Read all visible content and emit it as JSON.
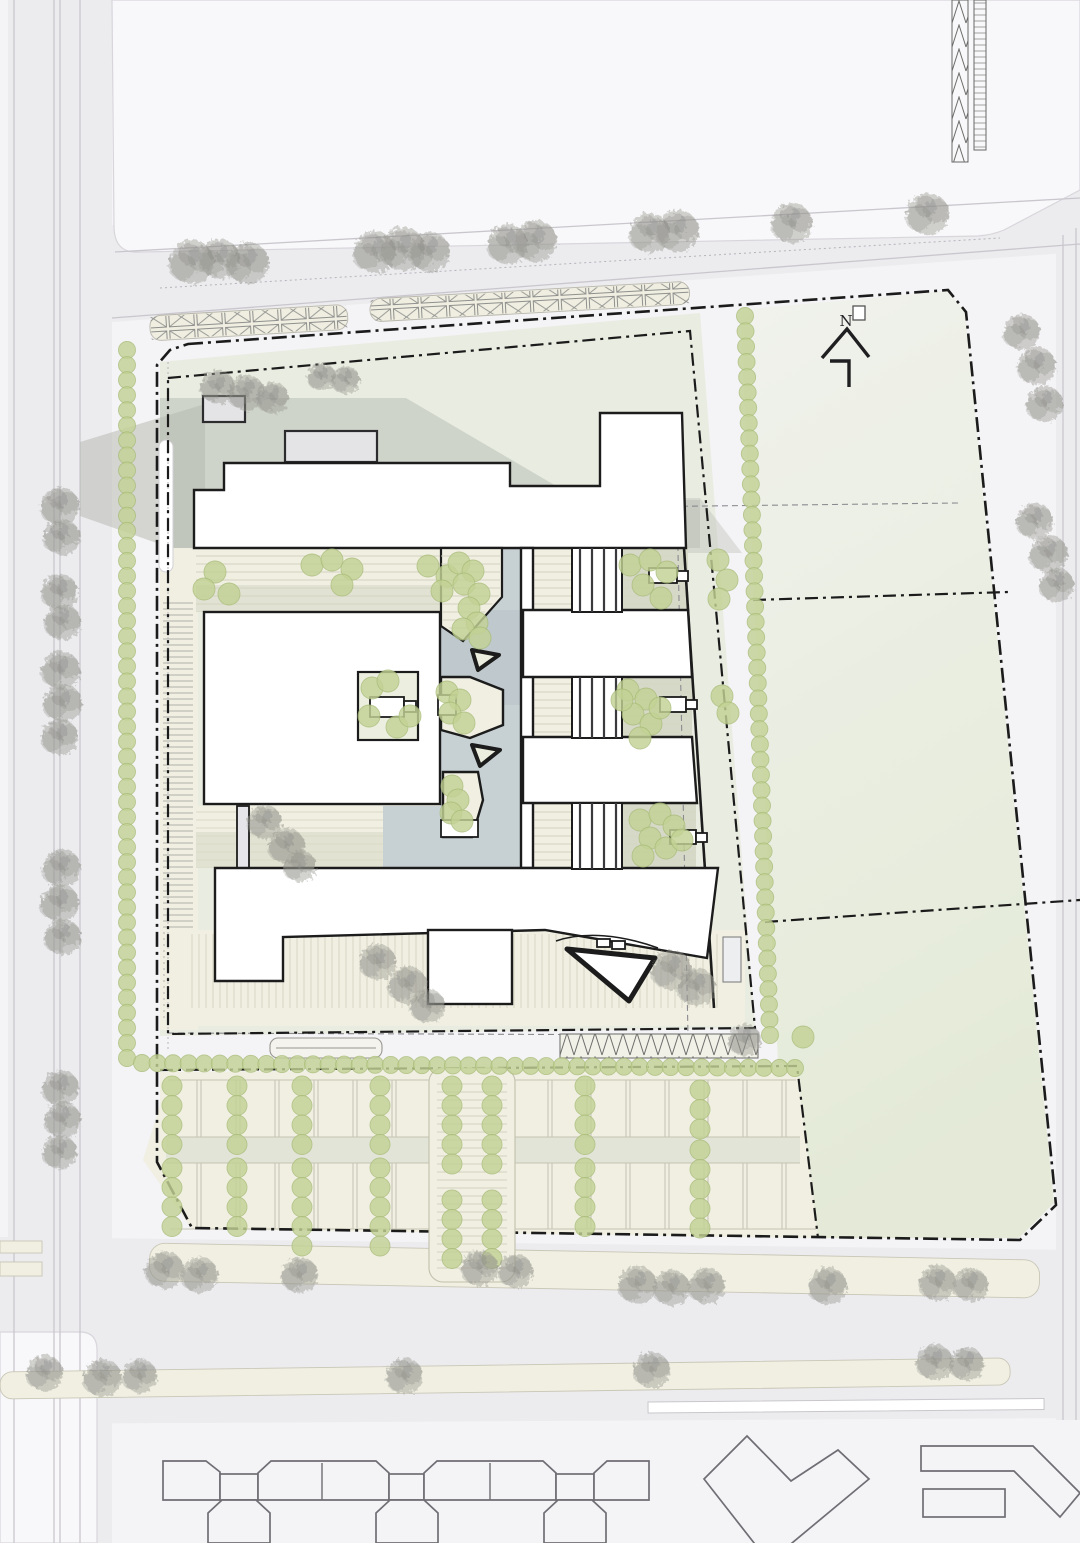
{
  "annotations": {
    "north_label": "N"
  },
  "palette": {
    "bg": "#f4f3f5",
    "block": "#f8f7f9",
    "block_stroke": "#d8d6db",
    "road": "#ecebee",
    "road_line": "#c9c7cd",
    "green_field_top": "#f0f2ec",
    "green_field_bottom": "#e4ead7",
    "site_green": "#e9ece1",
    "shadow_gray": "#ced3c8",
    "shadow_dark": "#b4b8ae",
    "cream": "#f0efe2",
    "cream_line": "#d8d6c1",
    "canal": "#c7d1d4",
    "courtyard_gray": "#d4d6c5",
    "courtyard_green": "#ecefdf",
    "aisle": "#e1e4d7",
    "building_fill": "#ffffff",
    "building_stroke": "#1c1c1c",
    "light_building_fill": "#f4f4f6",
    "light_building_stroke": "#6f6e74",
    "bush": "#c3d295",
    "bush_dark": "#a9bd79",
    "tree": "#96968f",
    "boundary": "#1b1b1b",
    "dashed_gray": "#8b8a90"
  },
  "boundaries": {
    "outer": "M188,344 L948,290 L966,312 L1056,1205 L1020,1240 L192,1228 L157,1162 L157,365 L170,350 Z",
    "inner": "M168,378 L690,331 L755,1028 L168,1034 Z",
    "parking_edge": "M160,1070 L797,1066 L818,1238",
    "green_div1": "M753,600 L1008,592",
    "green_div2": "M765,922 L1080,900",
    "setback_h": "M202,512 L958,503",
    "setback_v": "M676,455 L688,1035",
    "setback_bottom": "M168,1033 L688,1035",
    "setback_left": "M168,362 L168,1050"
  },
  "north_arrow": {
    "chevron": "M822,358 L847,329 L869,357",
    "tail": "M830,361 L849,361 L849,387"
  },
  "vegetation": {
    "gray_trees": [
      {
        "x": 192,
        "y": 262,
        "r": 22
      },
      {
        "x": 220,
        "y": 259,
        "r": 20
      },
      {
        "x": 248,
        "y": 263,
        "r": 21
      },
      {
        "x": 375,
        "y": 252,
        "r": 21
      },
      {
        "x": 403,
        "y": 249,
        "r": 22
      },
      {
        "x": 430,
        "y": 252,
        "r": 20
      },
      {
        "x": 508,
        "y": 244,
        "r": 20
      },
      {
        "x": 536,
        "y": 241,
        "r": 21
      },
      {
        "x": 650,
        "y": 233,
        "r": 20
      },
      {
        "x": 678,
        "y": 231,
        "r": 21
      },
      {
        "x": 792,
        "y": 223,
        "r": 20
      },
      {
        "x": 928,
        "y": 214,
        "r": 21
      },
      {
        "x": 1022,
        "y": 332,
        "r": 18
      },
      {
        "x": 1037,
        "y": 366,
        "r": 19
      },
      {
        "x": 1045,
        "y": 404,
        "r": 18
      },
      {
        "x": 1035,
        "y": 521,
        "r": 18
      },
      {
        "x": 1049,
        "y": 554,
        "r": 19
      },
      {
        "x": 1057,
        "y": 585,
        "r": 17
      },
      {
        "x": 60,
        "y": 506,
        "r": 19
      },
      {
        "x": 62,
        "y": 537,
        "r": 18
      },
      {
        "x": 60,
        "y": 592,
        "r": 18
      },
      {
        "x": 63,
        "y": 622,
        "r": 18
      },
      {
        "x": 61,
        "y": 670,
        "r": 19
      },
      {
        "x": 63,
        "y": 703,
        "r": 19
      },
      {
        "x": 60,
        "y": 737,
        "r": 18
      },
      {
        "x": 62,
        "y": 868,
        "r": 19
      },
      {
        "x": 60,
        "y": 903,
        "r": 19
      },
      {
        "x": 63,
        "y": 937,
        "r": 18
      },
      {
        "x": 61,
        "y": 1088,
        "r": 18
      },
      {
        "x": 63,
        "y": 1120,
        "r": 18
      },
      {
        "x": 60,
        "y": 1152,
        "r": 17
      },
      {
        "x": 218,
        "y": 387,
        "r": 17
      },
      {
        "x": 247,
        "y": 393,
        "r": 18
      },
      {
        "x": 273,
        "y": 398,
        "r": 16
      },
      {
        "x": 322,
        "y": 377,
        "r": 14
      },
      {
        "x": 346,
        "y": 380,
        "r": 14
      },
      {
        "x": 265,
        "y": 822,
        "r": 17
      },
      {
        "x": 287,
        "y": 846,
        "r": 18
      },
      {
        "x": 300,
        "y": 866,
        "r": 16
      },
      {
        "x": 378,
        "y": 962,
        "r": 18
      },
      {
        "x": 408,
        "y": 985,
        "r": 19
      },
      {
        "x": 428,
        "y": 1006,
        "r": 17
      },
      {
        "x": 672,
        "y": 970,
        "r": 20
      },
      {
        "x": 697,
        "y": 987,
        "r": 19
      },
      {
        "x": 745,
        "y": 1040,
        "r": 16
      },
      {
        "x": 165,
        "y": 1270,
        "r": 19
      },
      {
        "x": 200,
        "y": 1275,
        "r": 18
      },
      {
        "x": 300,
        "y": 1275,
        "r": 18
      },
      {
        "x": 480,
        "y": 1268,
        "r": 18
      },
      {
        "x": 516,
        "y": 1271,
        "r": 17
      },
      {
        "x": 638,
        "y": 1285,
        "r": 19
      },
      {
        "x": 672,
        "y": 1288,
        "r": 18
      },
      {
        "x": 707,
        "y": 1286,
        "r": 18
      },
      {
        "x": 828,
        "y": 1286,
        "r": 19
      },
      {
        "x": 938,
        "y": 1283,
        "r": 18
      },
      {
        "x": 971,
        "y": 1285,
        "r": 17
      },
      {
        "x": 45,
        "y": 1373,
        "r": 18
      },
      {
        "x": 103,
        "y": 1378,
        "r": 19
      },
      {
        "x": 140,
        "y": 1376,
        "r": 17
      },
      {
        "x": 405,
        "y": 1376,
        "r": 18
      },
      {
        "x": 652,
        "y": 1370,
        "r": 18
      },
      {
        "x": 935,
        "y": 1362,
        "r": 18
      },
      {
        "x": 967,
        "y": 1364,
        "r": 17
      }
    ],
    "bushes": [
      {
        "x": 215,
        "y": 572
      },
      {
        "x": 204,
        "y": 589
      },
      {
        "x": 229,
        "y": 594
      },
      {
        "x": 312,
        "y": 565
      },
      {
        "x": 332,
        "y": 560
      },
      {
        "x": 352,
        "y": 569
      },
      {
        "x": 342,
        "y": 585
      },
      {
        "x": 428,
        "y": 566
      },
      {
        "x": 447,
        "y": 576
      },
      {
        "x": 442,
        "y": 591
      },
      {
        "x": 459,
        "y": 563
      },
      {
        "x": 473,
        "y": 571
      },
      {
        "x": 464,
        "y": 584
      },
      {
        "x": 479,
        "y": 594
      },
      {
        "x": 469,
        "y": 608
      },
      {
        "x": 477,
        "y": 623
      },
      {
        "x": 463,
        "y": 629
      },
      {
        "x": 480,
        "y": 638
      },
      {
        "x": 630,
        "y": 565
      },
      {
        "x": 650,
        "y": 560
      },
      {
        "x": 667,
        "y": 572
      },
      {
        "x": 643,
        "y": 585
      },
      {
        "x": 661,
        "y": 598
      },
      {
        "x": 718,
        "y": 560
      },
      {
        "x": 727,
        "y": 580
      },
      {
        "x": 719,
        "y": 599
      },
      {
        "x": 372,
        "y": 688
      },
      {
        "x": 388,
        "y": 681
      },
      {
        "x": 369,
        "y": 716
      },
      {
        "x": 397,
        "y": 727
      },
      {
        "x": 410,
        "y": 716
      },
      {
        "x": 447,
        "y": 692
      },
      {
        "x": 460,
        "y": 700
      },
      {
        "x": 450,
        "y": 713
      },
      {
        "x": 464,
        "y": 723
      },
      {
        "x": 452,
        "y": 786
      },
      {
        "x": 458,
        "y": 800
      },
      {
        "x": 451,
        "y": 813
      },
      {
        "x": 462,
        "y": 821
      },
      {
        "x": 628,
        "y": 690
      },
      {
        "x": 646,
        "y": 699
      },
      {
        "x": 633,
        "y": 714
      },
      {
        "x": 651,
        "y": 724
      },
      {
        "x": 640,
        "y": 738
      },
      {
        "x": 660,
        "y": 708
      },
      {
        "x": 622,
        "y": 700
      },
      {
        "x": 722,
        "y": 696
      },
      {
        "x": 728,
        "y": 713
      },
      {
        "x": 640,
        "y": 820
      },
      {
        "x": 660,
        "y": 814
      },
      {
        "x": 674,
        "y": 826
      },
      {
        "x": 650,
        "y": 838
      },
      {
        "x": 666,
        "y": 848
      },
      {
        "x": 682,
        "y": 840
      },
      {
        "x": 643,
        "y": 856
      },
      {
        "x": 803,
        "y": 1037
      }
    ],
    "hedges": [
      {
        "x1": 127,
        "y1": 350,
        "x2": 127,
        "y2": 1058,
        "step": 15,
        "r": 8.5
      },
      {
        "x1": 745,
        "y1": 316,
        "x2": 770,
        "y2": 1035,
        "step": 15,
        "r": 8.5
      },
      {
        "x1": 142,
        "y1": 1063,
        "x2": 795,
        "y2": 1068,
        "step": 15.5,
        "r": 8.5
      }
    ],
    "parking_columns": {
      "step": 19.5,
      "r": 10,
      "items": [
        {
          "x": 172,
          "y0": 1086,
          "n": 4
        },
        {
          "x": 172,
          "y0": 1168,
          "n": 4
        },
        {
          "x": 237,
          "y0": 1086,
          "n": 4
        },
        {
          "x": 237,
          "y0": 1168,
          "n": 4
        },
        {
          "x": 302,
          "y0": 1086,
          "n": 4
        },
        {
          "x": 302,
          "y0": 1168,
          "n": 5
        },
        {
          "x": 380,
          "y0": 1086,
          "n": 4
        },
        {
          "x": 380,
          "y0": 1168,
          "n": 5
        },
        {
          "x": 452,
          "y0": 1086,
          "n": 5
        },
        {
          "x": 452,
          "y0": 1200,
          "n": 4
        },
        {
          "x": 492,
          "y0": 1086,
          "n": 5
        },
        {
          "x": 492,
          "y0": 1200,
          "n": 4
        },
        {
          "x": 585,
          "y0": 1086,
          "n": 4
        },
        {
          "x": 585,
          "y0": 1168,
          "n": 4
        },
        {
          "x": 700,
          "y0": 1090,
          "n": 3
        },
        {
          "x": 700,
          "y0": 1150,
          "n": 5
        }
      ]
    }
  }
}
